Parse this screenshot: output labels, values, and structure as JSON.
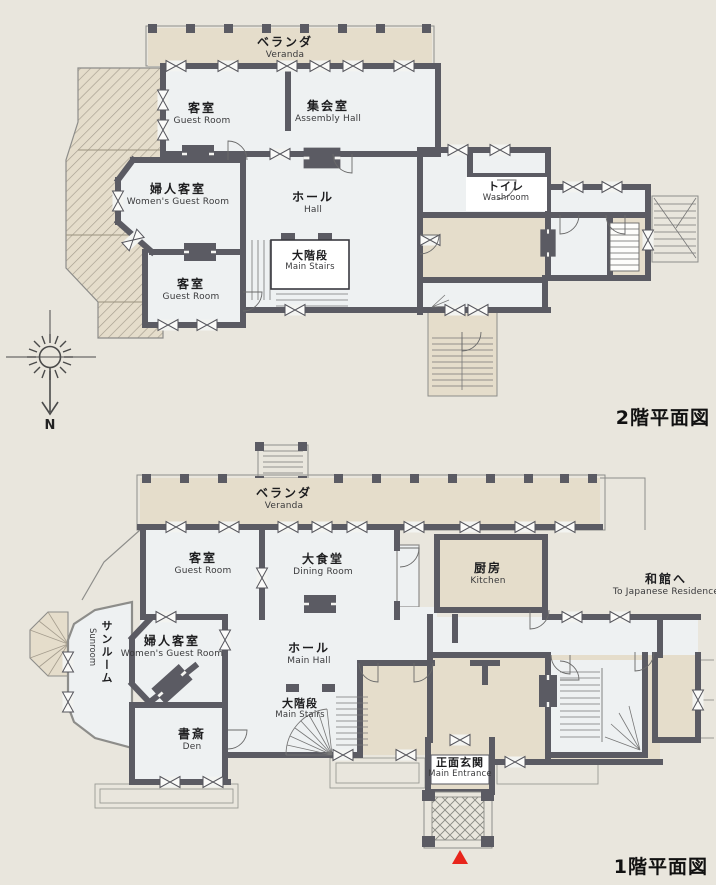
{
  "document": {
    "type_note": "floor plan diagram"
  },
  "colors": {
    "paper": "#e9e6dd",
    "beige": "#e5ddcb",
    "room": "#eef1f2",
    "wall": "#5b5b63",
    "thin_line": "#8d8d8a",
    "hatch_line": "#a59d8e",
    "accent_red": "#e8251c"
  },
  "floor2": {
    "title": "2階平面図",
    "compass_north": "N",
    "veranda": {
      "jp": "ベランダ",
      "en": "Veranda"
    },
    "guest_top": {
      "jp": "客室",
      "en": "Guest Room"
    },
    "assembly": {
      "jp": "集会室",
      "en": "Assembly Hall"
    },
    "womens": {
      "jp": "婦人客室",
      "en": "Women's Guest Room"
    },
    "hall": {
      "jp": "ホール",
      "en": "Hall"
    },
    "stairs": {
      "jp": "大階段",
      "en": "Main Stairs"
    },
    "guest_bottom": {
      "jp": "客室",
      "en": "Guest Room"
    },
    "washroom": {
      "jp": "トイレ",
      "en": "Washroom"
    }
  },
  "floor1": {
    "title": "1階平面図",
    "veranda": {
      "jp": "ベランダ",
      "en": "Veranda"
    },
    "guest": {
      "jp": "客室",
      "en": "Guest Room"
    },
    "dining": {
      "jp": "大食堂",
      "en": "Dining Room"
    },
    "kitchen": {
      "jp": "厨房",
      "en": "Kitchen"
    },
    "sunroom": {
      "jp": "サンルーム",
      "en": "Sunroom"
    },
    "womens": {
      "jp": "婦人客室",
      "en": "Women's Guest Room"
    },
    "hall": {
      "jp": "ホール",
      "en": "Main Hall"
    },
    "stairs": {
      "jp": "大階段",
      "en": "Main Stairs"
    },
    "den": {
      "jp": "書斎",
      "en": "Den"
    },
    "entrance": {
      "jp": "正面玄関",
      "en": "Main Entrance"
    },
    "to_japanese_residence": {
      "jp": "和館へ",
      "en": "To Japanese Residence"
    }
  }
}
